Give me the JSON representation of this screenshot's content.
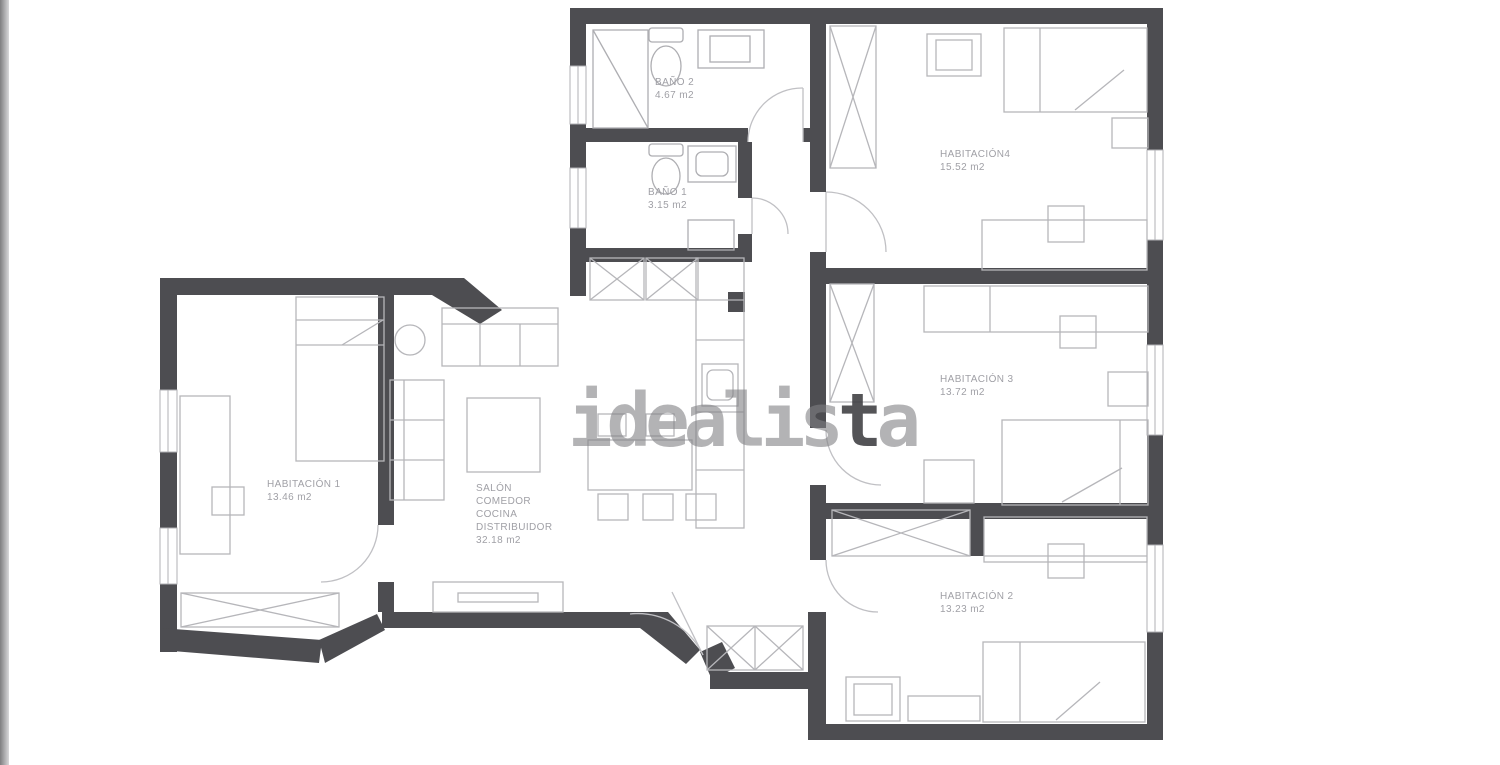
{
  "watermark": {
    "pre": "idealis",
    "dark": "t",
    "post": "a"
  },
  "rooms": {
    "bano2": {
      "name": "BAÑO 2",
      "area": "4.67 m2"
    },
    "bano1": {
      "name": "BAÑO 1",
      "area": "3.15 m2"
    },
    "hab4": {
      "name": "HABITACIÓN4",
      "area": "15.52 m2"
    },
    "hab3": {
      "name": "HABITACIÓN 3",
      "area": "13.72 m2"
    },
    "hab2": {
      "name": "HABITACIÓN 2",
      "area": "13.23 m2"
    },
    "hab1": {
      "name": "HABITACIÓN 1",
      "area": "13.46 m2"
    },
    "salon": {
      "line1": "SALÓN",
      "line2": "COMEDOR",
      "line3": "COCINA",
      "line4": "DISTRIBUIDOR",
      "area": "32.18 m2"
    }
  },
  "colors": {
    "wall": "#4d4d51",
    "furniture": "#b6b6ba",
    "label": "#a0a0a6"
  }
}
